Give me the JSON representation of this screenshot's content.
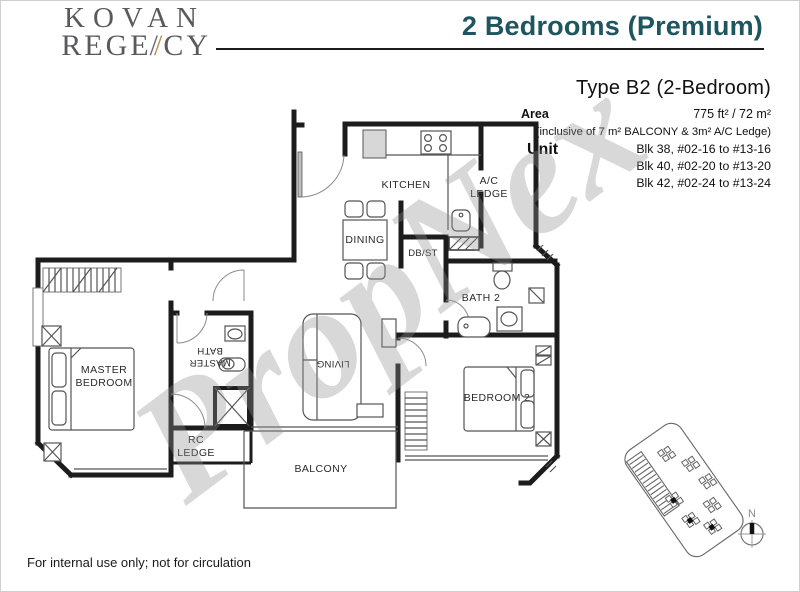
{
  "header": {
    "logo_line1": "KOVAN",
    "logo_line2_pre": "REGE",
    "logo_slash_gray": "/",
    "logo_slash_gold": "/",
    "logo_line2_post": "CY",
    "title": "2 Bedrooms (Premium)"
  },
  "colors": {
    "title_teal": "#1d5560",
    "logo_gray": "#5a5a5e",
    "logo_gold": "#b3905a",
    "wall_black": "#1c1c1c",
    "watermark_gray": "#8f8f8f"
  },
  "info": {
    "type_title": "Type B2 (2-Bedroom)",
    "area_label": "Area",
    "area_value": "775 ft² / 72 m²",
    "area_note": "(inclusive of 7 m² BALCONY & 3m² A/C Ledge)",
    "unit_label": "Unit",
    "unit_line1": "Blk 38, #02-16 to #13-16",
    "unit_line2": "Blk 40, #02-20 to #13-20",
    "unit_line3": "Blk 42, #02-24 to #13-24"
  },
  "plan": {
    "labels": {
      "kitchen": "KITCHEN",
      "ac_line1": "A/C",
      "ac_line2": "LEDGE",
      "dining": "DINING",
      "dbst": "DB/ST",
      "bath2": "BATH 2",
      "master_line1": "MASTER",
      "master_line2": "BEDROOM",
      "masterbath_line1": "MASTER",
      "masterbath_line2": "BATH",
      "rc_line1": "RC",
      "rc_line2": "LEDGE",
      "living": "LIVING",
      "bedroom2": "BEDROOM 2",
      "balcony": "BALCONY"
    }
  },
  "watermark": {
    "text": "PropNex"
  },
  "compass": {
    "north_label": "N"
  },
  "footer": {
    "note": "For internal use only; not for circulation"
  }
}
